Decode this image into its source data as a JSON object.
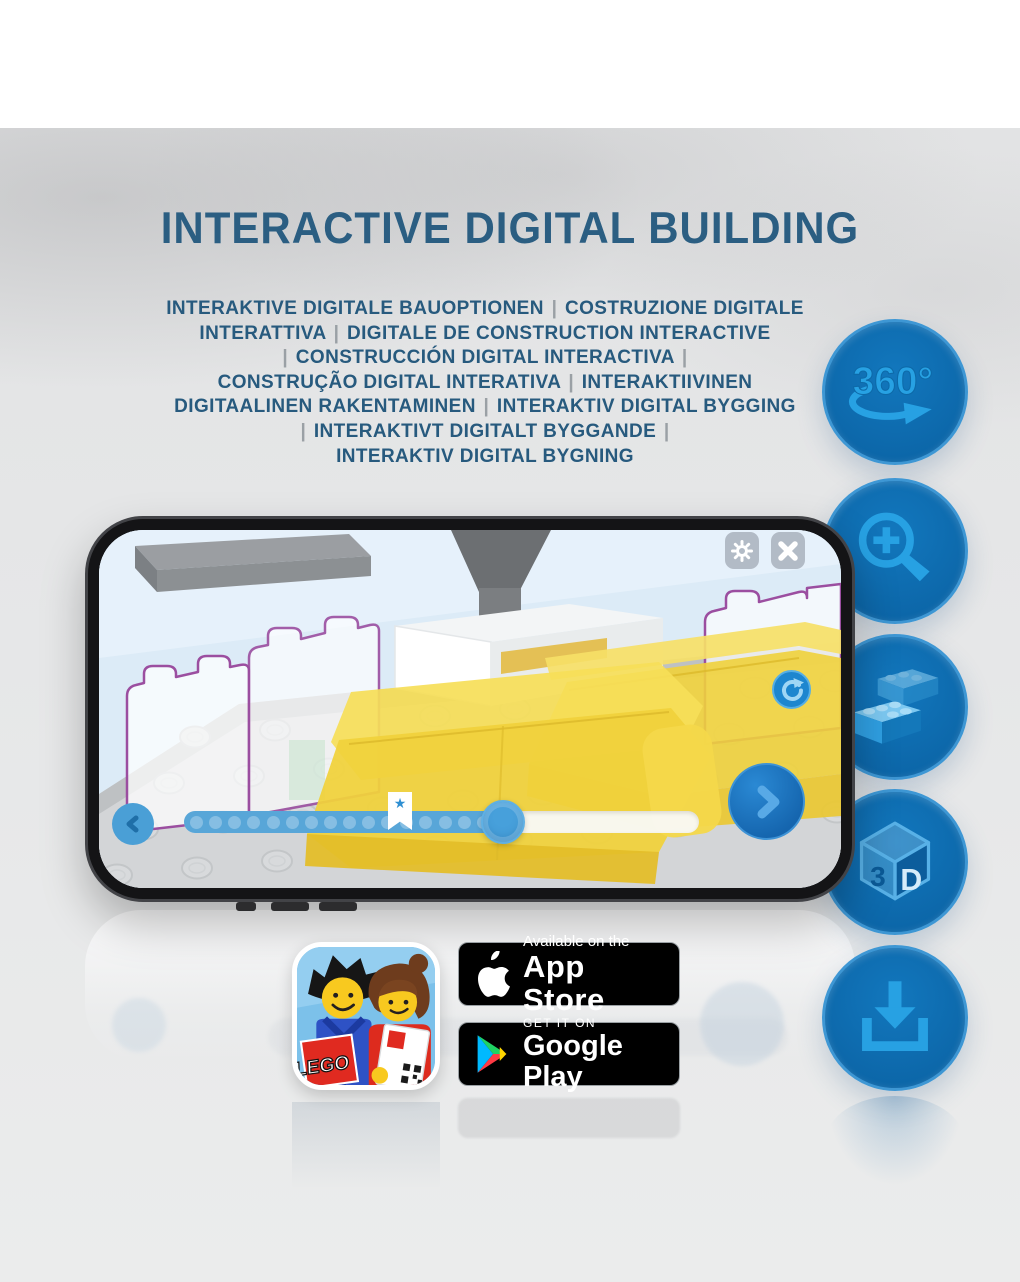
{
  "title": {
    "text": "INTERACTIVE DIGITAL BUILDING"
  },
  "subtitle": {
    "lines": [
      "INTERAKTIVE DIGITALE BAUOPTIONEN | COSTRUZIONE DIGITALE",
      "INTERATTIVA | DIGITALE DE CONSTRUCTION INTERACTIVE",
      "| CONSTRUCCIÓN DIGITAL INTERACTIVA |",
      "CONSTRUÇÃO DIGITAL INTERATIVA | INTERAKTIIVINEN",
      "DIGITAALINEN RAKENTAMINEN | INTERAKTIV DIGITAL BYGGING",
      "| INTERAKTIVT DIGITALT BYGGANDE |",
      "INTERAKTIV DIGITAL BYGNING"
    ]
  },
  "features": [
    {
      "icon": "360-rotation-icon",
      "label": "360°"
    },
    {
      "icon": "zoom-in-icon"
    },
    {
      "icon": "lego-bricks-icon"
    },
    {
      "icon": "3d-cube-icon",
      "label": "3D"
    },
    {
      "icon": "download-icon"
    }
  ],
  "phone": {
    "screen_ui": {
      "top_buttons": [
        "settings-gear",
        "close"
      ],
      "rotate_button": "rotate-view",
      "progress": {
        "total_steps": 17,
        "current_fraction": 0.62,
        "bookmark_fraction": 0.42
      }
    }
  },
  "store_badges": {
    "app_store": {
      "tagline": "Available on the",
      "name": "App Store"
    },
    "google_play": {
      "tagline": "GET IT ON",
      "name": "Google Play"
    },
    "app_icon": {
      "logo_text": "LEGO"
    }
  },
  "colors": {
    "title_blue": "#2b5e82",
    "separator_gray": "#9aa0a5",
    "circle_blue": "#0e6fb4",
    "icon_light_blue": "#27a1e3",
    "screen_sky": "#dcebf7",
    "brick_yellow": "#f0d13c",
    "ghost_outline_purple": "#9b4ea0",
    "badge_black": "#000000"
  }
}
